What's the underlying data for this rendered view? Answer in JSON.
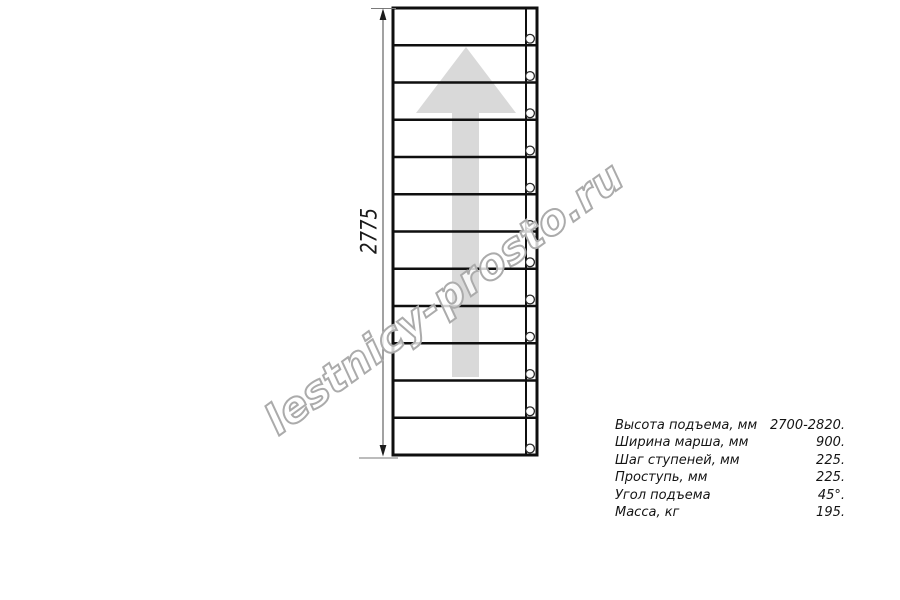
{
  "watermark": {
    "text": "lestnicy-prosto.ru"
  },
  "drawing": {
    "dimension_label": "2775",
    "steps_count": 12,
    "arrow_direction": "up",
    "colors": {
      "line": "#0f0f0f",
      "arrow": "#d9d9d9",
      "dimension": "#7a7a7a",
      "watermark_outline": "#ababab"
    }
  },
  "specs": {
    "rows": [
      {
        "label": "Высота подъема, мм",
        "value": "2700-2820."
      },
      {
        "label": "Ширина марша, мм",
        "value": "900."
      },
      {
        "label": "Шаг ступеней, мм",
        "value": "225."
      },
      {
        "label": "Проступь, мм",
        "value": "225."
      },
      {
        "label": "Угол подъема",
        "value": "45°."
      },
      {
        "label": "Масса, кг",
        "value": "195."
      }
    ]
  }
}
